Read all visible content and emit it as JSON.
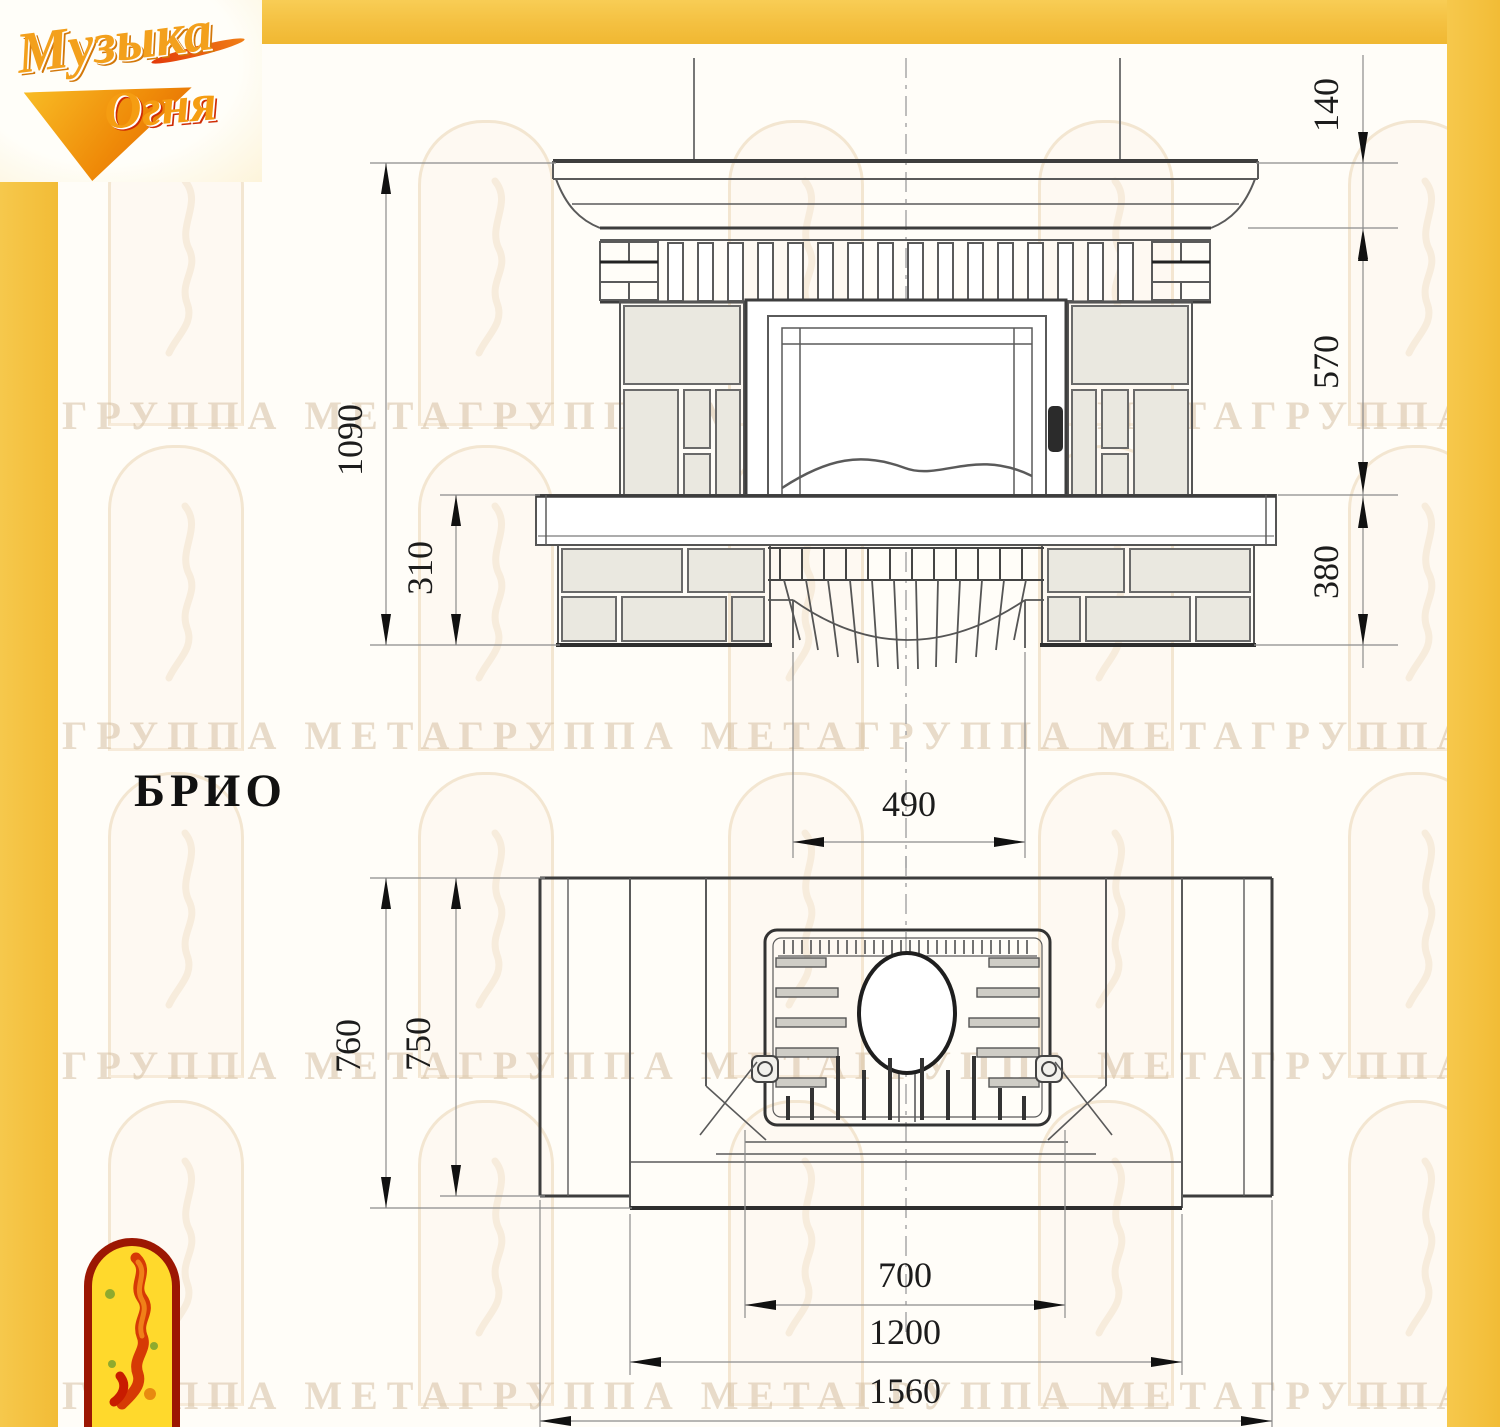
{
  "title": "БРИО",
  "logo": {
    "word1": "Музыка",
    "word2": "Огня"
  },
  "watermark": {
    "text": "ГРУППА МЕТАГРУППА МЕТАГРУППА МЕТАГРУППА МЕТА"
  },
  "front_view": {
    "dims": {
      "total_height": "1090",
      "base_height": "310",
      "shelf_height": "140",
      "middle_height": "570",
      "lower_height": "380",
      "niche_width": "490"
    }
  },
  "plan_view": {
    "dims": {
      "total_depth": "760",
      "body_depth": "750",
      "firebox_width": "700",
      "body_width": "1200",
      "total_width": "1560"
    }
  },
  "colors": {
    "frame_gold": "#f4c040",
    "drawing_line": "#555555",
    "dimension_ink": "#1c1c1c",
    "tile_fill": "#eae8e0",
    "watermark_tint": "#d5bfa3",
    "emblem_red": "#9c1703",
    "emblem_yellow": "#ffd92c"
  }
}
